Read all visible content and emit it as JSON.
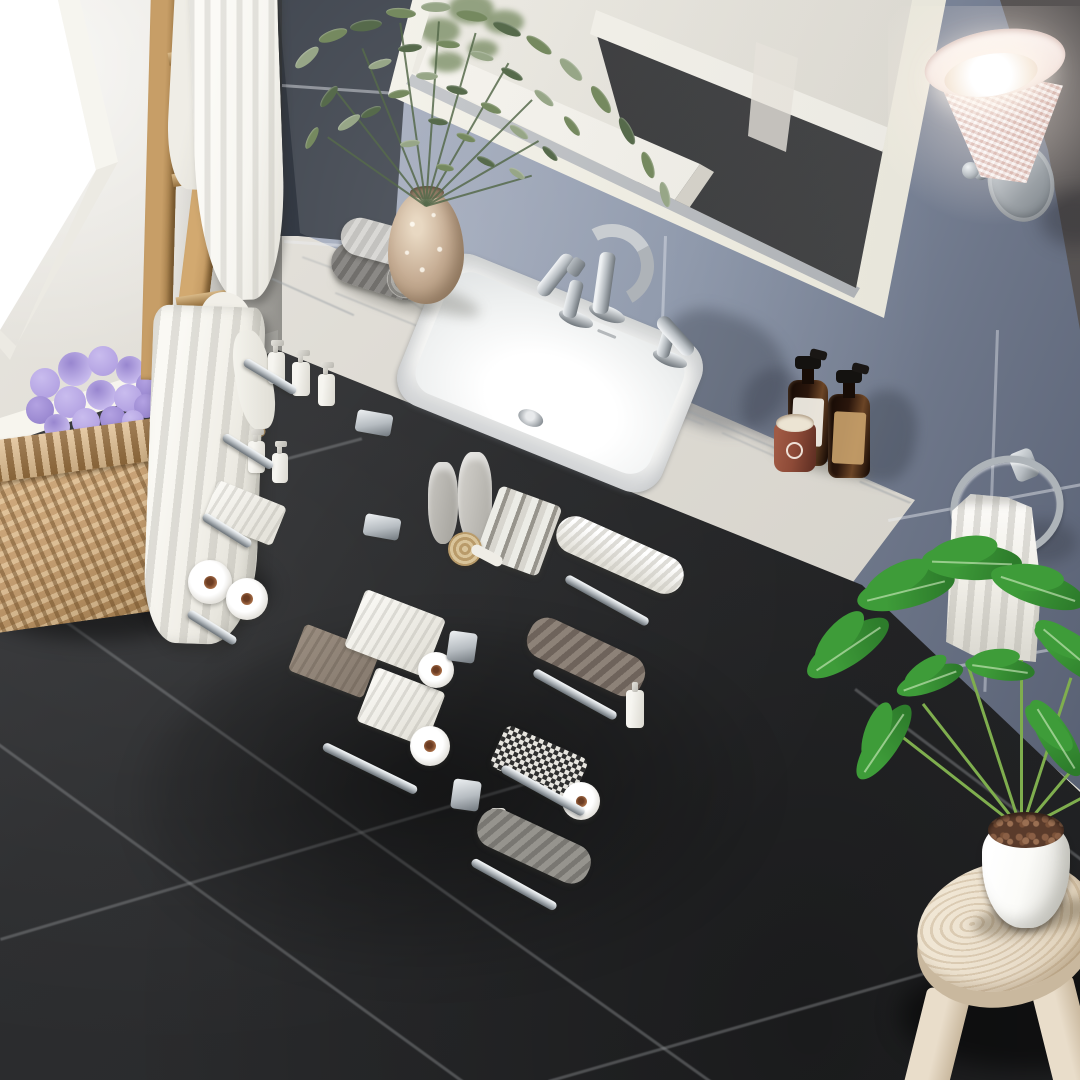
{
  "canvas": {
    "width": 1080,
    "height": 1080
  },
  "scene_type": "bathroom interior product photograph, top-down three-quarter view",
  "palette": {
    "wall": "#dfdcd5",
    "wall_shade": "#cac7bf",
    "window_glow": "#ffffff",
    "tile_light": "#b7bdcc",
    "tile_mid": "#99a2b5",
    "tile_deep": "#6d7689",
    "tile_shadow": "#596174",
    "tile_dark": "#343a44",
    "tile_dark2": "#4a4f5b",
    "tile_taupe": "#5e5653",
    "grout": "#e8ebf0",
    "baseboard": "#f3f1ea",
    "baseboard_shade": "#d8d5cb",
    "floor": "#2c2d2f",
    "floor_hi": "#3a3b3e",
    "floor_grout": "#96989c",
    "cabinet": "#f5f4ed",
    "cabinet_shade": "#e2e0d4",
    "cabinet_deep": "#cbc9bc",
    "counter": "#f7f7f4",
    "counter_edge": "#e3e3de",
    "vein": "#9aa0a6",
    "birch": "#d9c28d",
    "birch_deep": "#bda063",
    "birch_side": "#b29252",
    "nickel_hi": "#eef1f3",
    "nickel": "#b6bcc1",
    "nickel_deep": "#70777d",
    "glass": "#e9e6df",
    "amber": "#2a160c",
    "amber_hi": "#6b4526",
    "label_white": "#efece4",
    "label_kraft": "#c7a06a",
    "terracotta": "#8d4a37",
    "wax": "#ece4d3",
    "towel_white": "#f7f6f1",
    "towel_fold": "#d6d4cc",
    "towel_gray": "#7f7d7a",
    "towel_light": "#cbc9c6",
    "towel_taupe": "#8a7e72",
    "ladder_wood": "#c79e67",
    "ladder_deep": "#96713f",
    "vase": "#c6ad94",
    "vase_hi": "#e8d8c2",
    "green_dark": "#566a4b",
    "green_mid": "#75895f",
    "green_sage": "#97a687",
    "stem_green": "#7fae4e",
    "philo": "#3e9c39",
    "philo_deep": "#2d7c2b",
    "hydrangea": "#b3a2e2",
    "hydrangea_hi": "#c9bcee",
    "hydrangea_deep": "#9886cf",
    "leafy": "#5d7a4a",
    "basket_tan": "#c49e72",
    "basket_deep": "#9a7649",
    "stool_wood": "#e9ddca",
    "stool_shade": "#c9b89e",
    "pot_white": "#fbfbf8",
    "soil": "#5a3b2b",
    "soil_dot": "#8a5f45",
    "shade_pink": "#f3e3df",
    "shade_weave": "#dcc0b8",
    "shade_rim": "#faf1ee"
  },
  "scene": {
    "labels": {
      "window": "Bright window",
      "wall": "Painted greige wall",
      "tile_wall": "Blue-gray tiled wall",
      "mirror": "White framed wall mirror with room reflection",
      "sconce": "Wall sconce with woven shade, lit",
      "towel_ring": "Brushed nickel towel ring with white hand towel",
      "ladder": "Wooden blanket ladder with white towels and bathrobe",
      "basket": "Wicker basket with purple hydrangea",
      "floor": "Dark slate tile floor",
      "vanity": "White bathroom vanity with open drawers and doors",
      "countertop": "White engineered marble countertop",
      "sink": "Rectangular undermount ceramic sink",
      "faucet": "Brushed nickel widespread faucet",
      "rolled_towels": "Two rolled gray towels",
      "vase": "Speckled ceramic vase with eucalyptus bouquet",
      "soap_bottles": "Two amber glass soap dispensers",
      "candle": "Terracotta candle cup",
      "left_drawers": "Open left drawer stack with toiletries, towels and toilet paper",
      "doors": "Open center doors with wire storage basket",
      "wide_drawer": "Wide bottom drawer with folded towels and toilet paper",
      "right_drawers": "Open right drawer stack with towels and toiletries",
      "side_panel": "Vanity right side panel",
      "stool": "Round wooden stool",
      "plant": "Potted philodendron in white pot"
    }
  }
}
